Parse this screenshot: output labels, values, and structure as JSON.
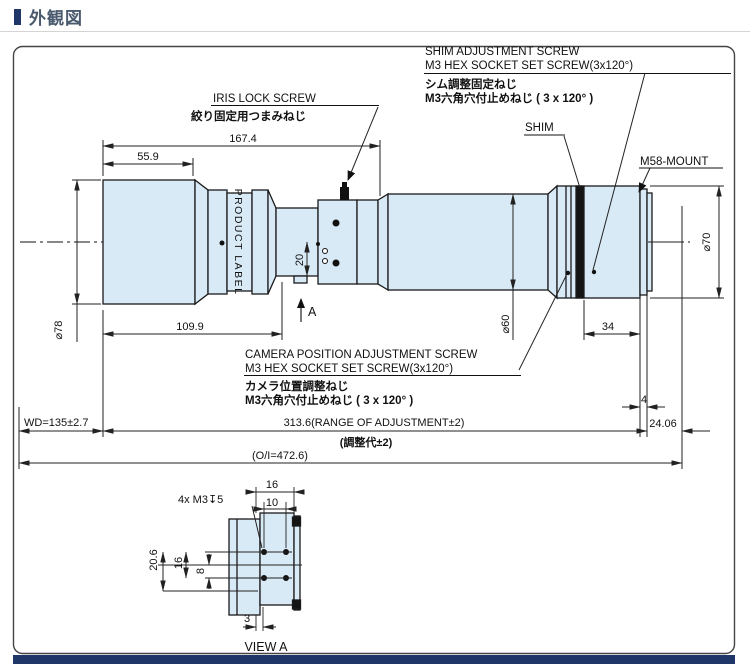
{
  "header": {
    "title": "外観図",
    "accent_color": "#1f3768"
  },
  "callouts": {
    "shim_adjust_en1": "SHIM ADJUSTMENT SCREW",
    "shim_adjust_en2": "M3 HEX SOCKET SET SCREW(3x120°)",
    "shim_adjust_jp1": "シム調整固定ねじ",
    "shim_adjust_jp2": "M3六角穴付止めねじ ( 3 x 120° )",
    "iris_en": "IRIS LOCK SCREW",
    "iris_jp": "絞り固定用つまみねじ",
    "shim": "SHIM",
    "mount": "M58-MOUNT",
    "camera_en1": "CAMERA POSITION ADJUSTMENT SCREW",
    "camera_en2": "M3 HEX SOCKET SET SCREW(3x120°)",
    "camera_jp1": "カメラ位置調整ねじ",
    "camera_jp2": "M3六角穴付止めねじ ( 3 x 120° )",
    "product_label": "PRODUCT LABEL",
    "view_dir": "A",
    "view_a_holes": "4x M3↧5",
    "view_a_title": "VIEW A"
  },
  "dims": {
    "front_len": "55.9",
    "front_to_iris": "167.4",
    "front_section": "109.9",
    "dia_front": "⌀78",
    "dia_main": "⌀60",
    "dia_rear": "⌀70",
    "iris_offset": "20",
    "shim_to_flange": "34",
    "flange_thickness": "4",
    "flange_back": "24.06",
    "working_distance": "WD=135±2.7",
    "adjustment_range": "313.6(RANGE OF ADJUSTMENT±2)",
    "adjustment_range_jp": "(調整代±2)",
    "overall": "(O/I=472.6)",
    "va_width": "16",
    "va_hole_h": "10",
    "va_height": "20.6",
    "va_hole_v": "16",
    "va_half": "8",
    "va_depth": "3"
  }
}
